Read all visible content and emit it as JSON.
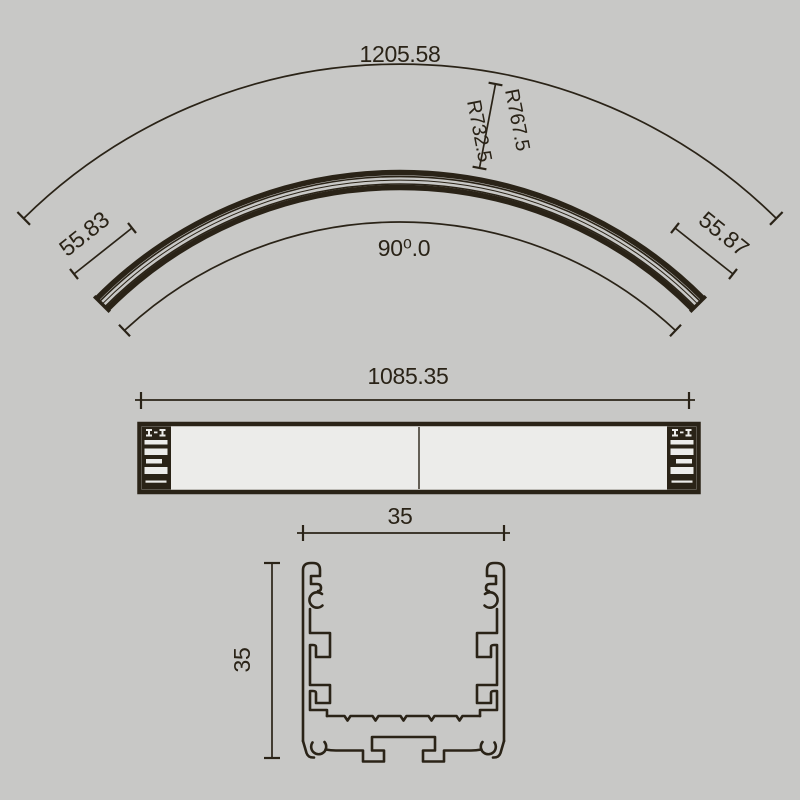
{
  "colors": {
    "background": "#c8c8c6",
    "line": "#2a2317"
  },
  "curved_view": {
    "outer_arc_length": "1205.58",
    "radius_outer": "R767.5",
    "radius_inner": "R732.5",
    "left_end_width": "55.83",
    "right_end_width": "55.87",
    "angle": "90⁰.0"
  },
  "side_view": {
    "length": "1085.35"
  },
  "section_view": {
    "width": "35",
    "height": "35"
  }
}
